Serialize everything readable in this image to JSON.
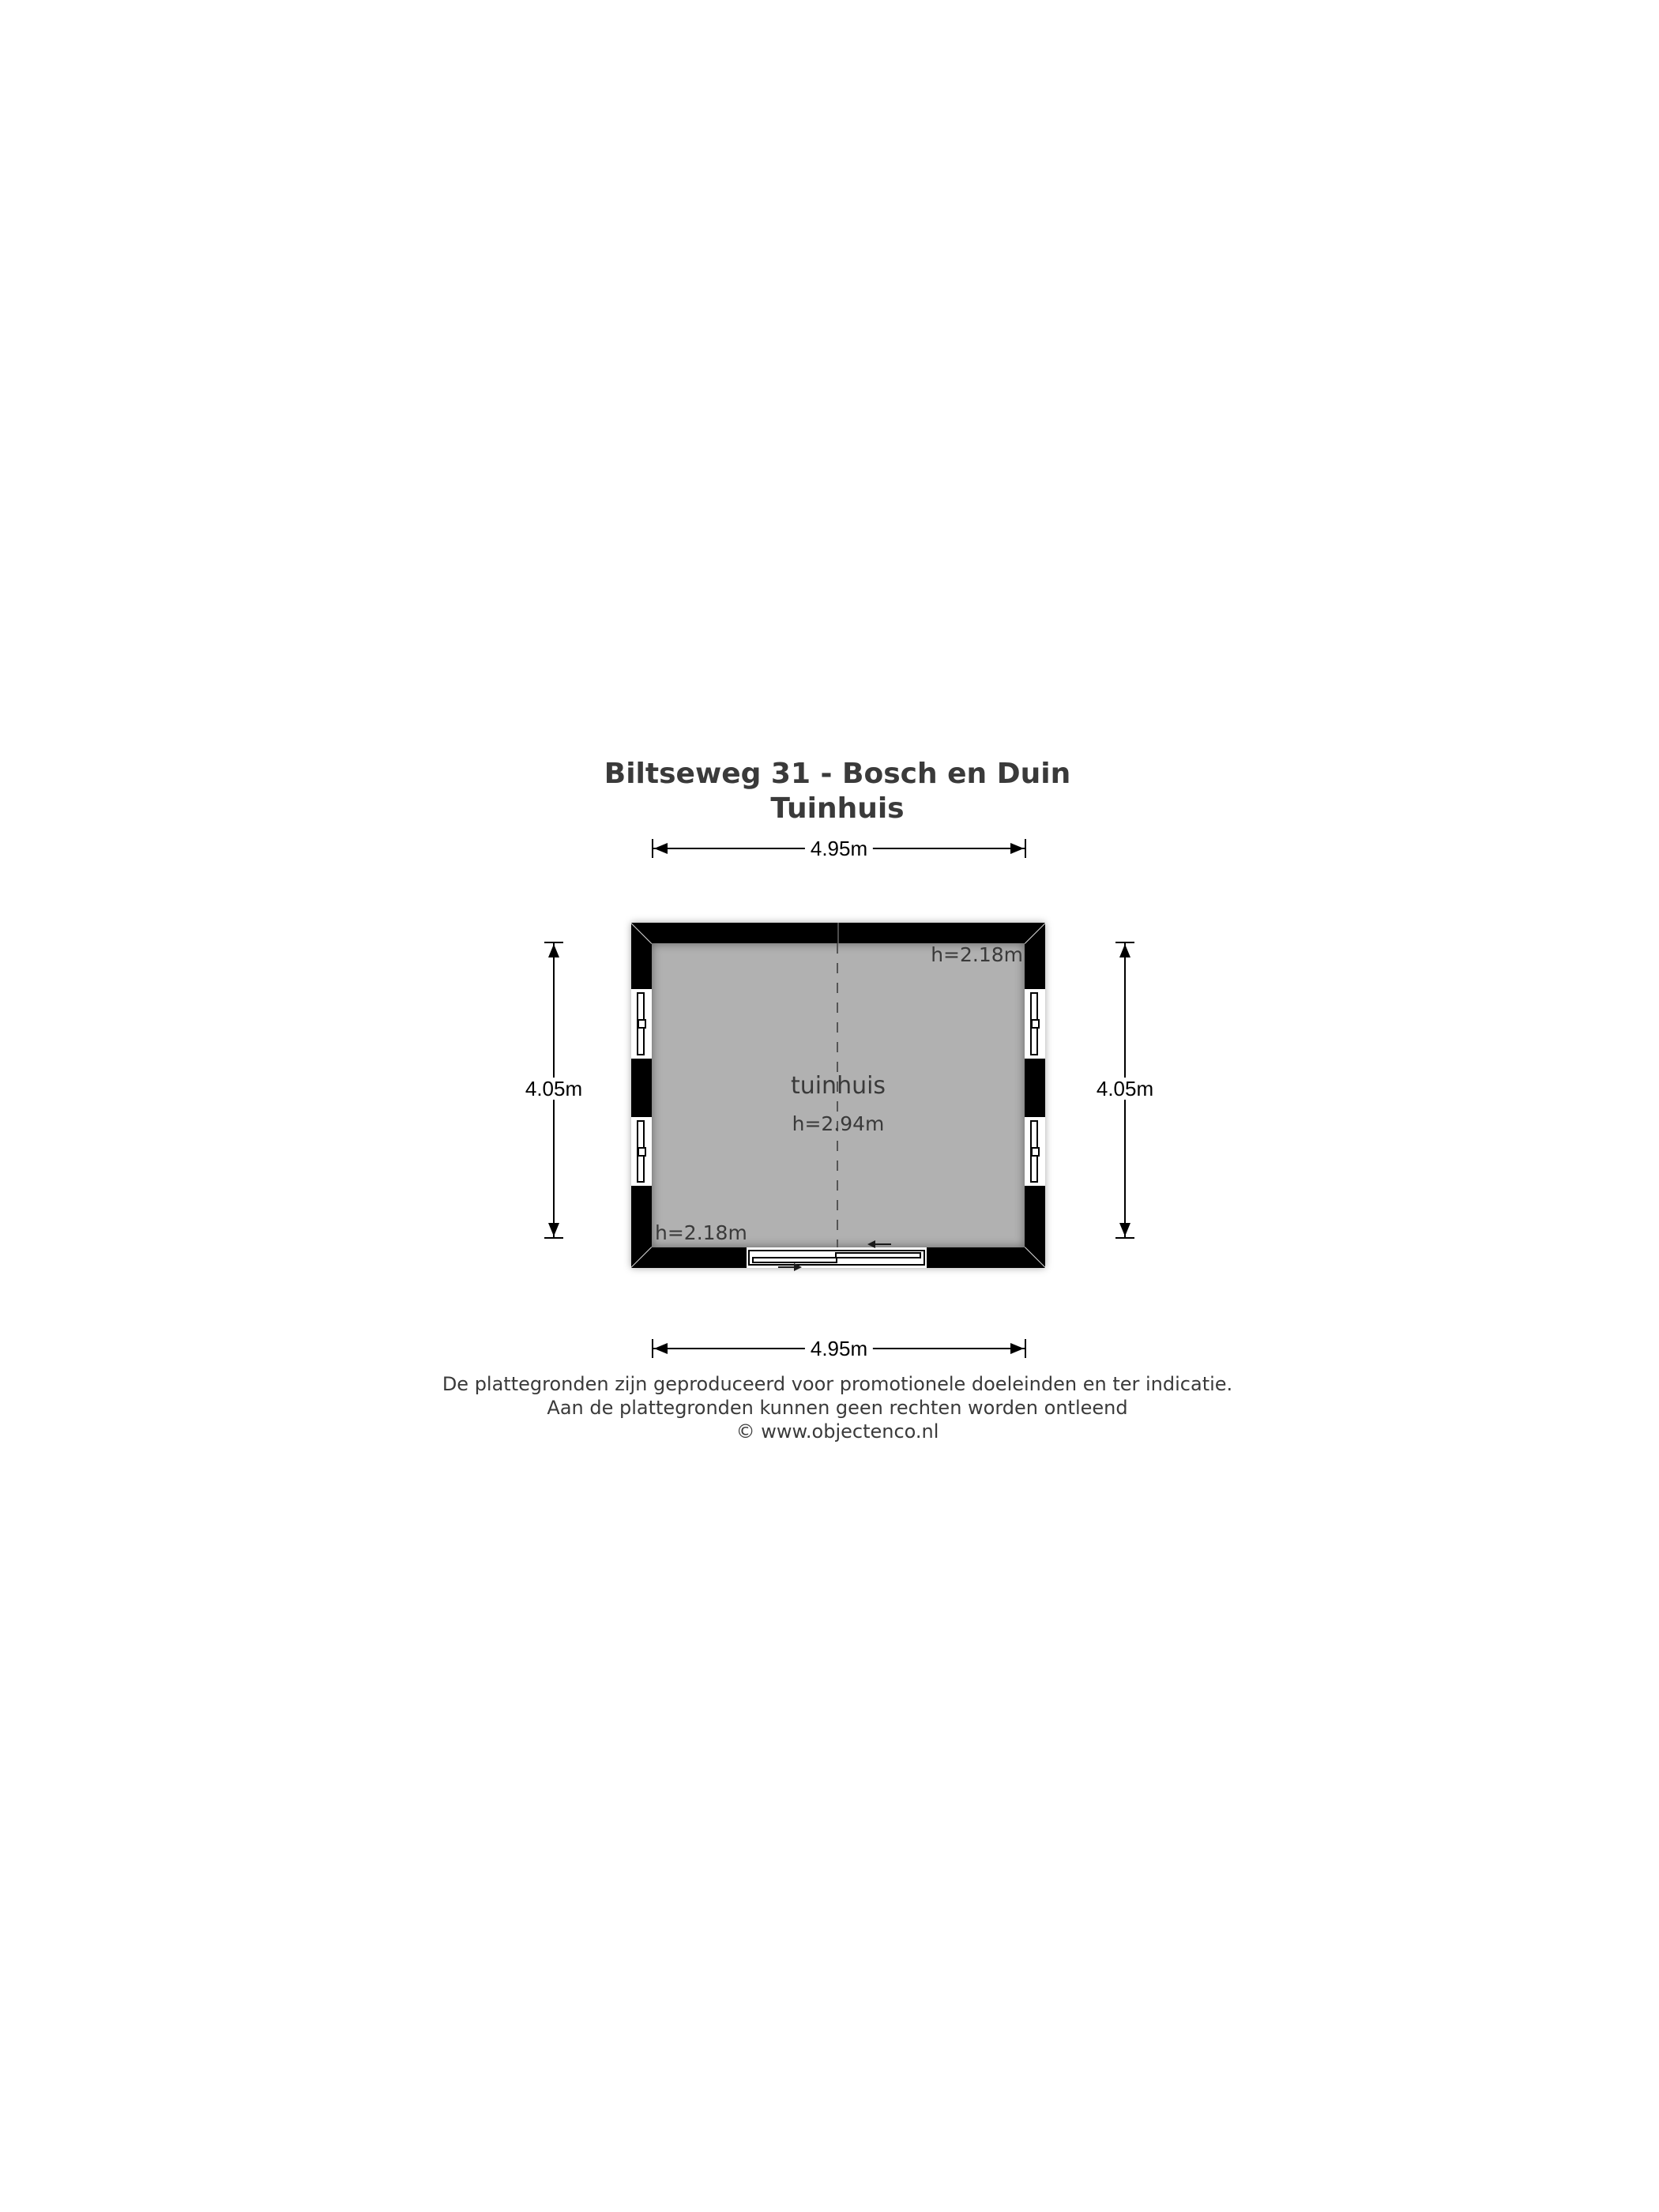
{
  "title": {
    "line1": "Biltseweg 31 - Bosch en Duin",
    "line2": "Tuinhuis"
  },
  "floorplan": {
    "room": {
      "name": "tuinhuis",
      "ceiling_height": "h=2.94m"
    },
    "corner_heights": {
      "top_right": "h=2.18m",
      "bottom_left": "h=2.18m"
    },
    "dimensions": {
      "width_top": "4.95m",
      "width_bottom": "4.95m",
      "height_left": "4.05m",
      "height_right": "4.05m"
    },
    "colors": {
      "wall": "#000000",
      "floor": "#b1b1b1",
      "annotation_text": "#3a3a3a",
      "dimension_line": "#000000",
      "dashed_center_line": "#555555"
    }
  },
  "footer": {
    "lines": [
      "De plattegronden zijn geproduceerd voor promotionele doeleinden en ter indicatie.",
      "Aan de plattegronden kunnen geen rechten worden ontleend",
      "© www.objectenco.nl"
    ]
  }
}
